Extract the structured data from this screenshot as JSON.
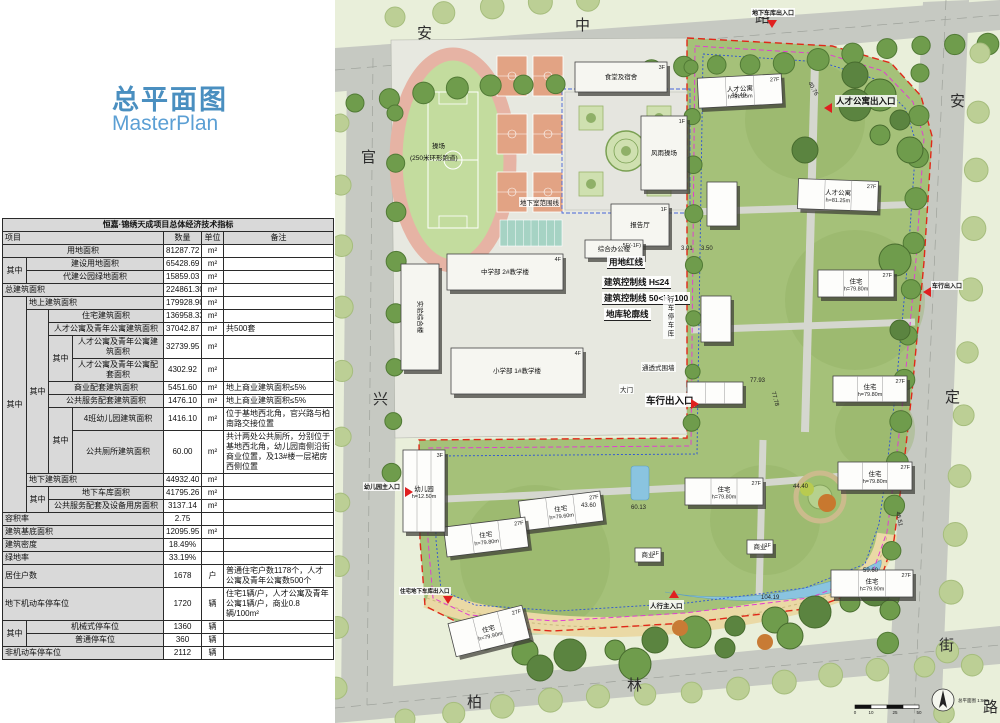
{
  "panel": {
    "title_cn": "总平面图",
    "title_en": "MasterPlan"
  },
  "table": {
    "rows": [
      [
        {
          "t": "恒嘉·锦绣天成项目总体经济技术指标",
          "cs": 7,
          "cls": "ttl"
        }
      ],
      [
        {
          "t": "项目",
          "cs": 4,
          "cls": "hd l"
        },
        {
          "t": "数量",
          "cls": "hd c"
        },
        {
          "t": "单位",
          "cls": "hd c"
        },
        {
          "t": "备注",
          "cls": "hd c"
        }
      ],
      [
        {
          "t": "用地面积",
          "cs": 4,
          "cls": "nm"
        },
        {
          "t": "81287.72",
          "cls": "num"
        },
        {
          "t": "m²",
          "cls": "unit"
        },
        {
          "t": "",
          "cls": "rmk"
        }
      ],
      [
        {
          "t": "其中",
          "rs": 2,
          "cls": "nm"
        },
        {
          "t": "建设用地面积",
          "cs": 3,
          "cls": "nm"
        },
        {
          "t": "65428.69",
          "cls": "num"
        },
        {
          "t": "m²",
          "cls": "unit"
        },
        {
          "t": "",
          "cls": "rmk"
        }
      ],
      [
        {
          "t": "代建公园绿地面积",
          "cs": 3,
          "cls": "nm"
        },
        {
          "t": "15859.03",
          "cls": "num"
        },
        {
          "t": "m²",
          "cls": "unit"
        },
        {
          "t": "",
          "cls": "rmk"
        }
      ],
      [
        {
          "t": "总建筑面积",
          "cs": 4,
          "cls": "nm l"
        },
        {
          "t": "224861.30",
          "cls": "num"
        },
        {
          "t": "m²",
          "cls": "unit"
        },
        {
          "t": "",
          "cls": "rmk"
        }
      ],
      [
        {
          "t": "其中",
          "rs": 12,
          "cls": "nm"
        },
        {
          "t": "地上建筑面积",
          "cs": 3,
          "cls": "nm l"
        },
        {
          "t": "179928.90",
          "cls": "num red"
        },
        {
          "t": "m²",
          "cls": "unit"
        },
        {
          "t": "",
          "cls": "rmk"
        }
      ],
      [
        {
          "t": "其中",
          "rs": 8,
          "cls": "nm"
        },
        {
          "t": "住宅建筑面积",
          "cs": 2,
          "cls": "nm"
        },
        {
          "t": "136958.33",
          "cls": "num"
        },
        {
          "t": "m²",
          "cls": "unit"
        },
        {
          "t": "",
          "cls": "rmk"
        }
      ],
      [
        {
          "t": "人才公寓及青年公寓建筑面积",
          "cs": 2,
          "cls": "nm"
        },
        {
          "t": "37042.87",
          "cls": "num"
        },
        {
          "t": "m²",
          "cls": "unit"
        },
        {
          "t": "共500套",
          "cls": "rmk"
        }
      ],
      [
        {
          "t": "其中",
          "rs": 2,
          "cls": "nm"
        },
        {
          "t": "人才公寓及青年公寓建筑面积",
          "cls": "nm"
        },
        {
          "t": "32739.95",
          "cls": "num"
        },
        {
          "t": "m²",
          "cls": "unit"
        },
        {
          "t": "",
          "cls": "rmk"
        }
      ],
      [
        {
          "t": "人才公寓及青年公寓配套面积",
          "cls": "nm"
        },
        {
          "t": "4302.92",
          "cls": "num"
        },
        {
          "t": "m²",
          "cls": "unit"
        },
        {
          "t": "",
          "cls": "rmk"
        }
      ],
      [
        {
          "t": "商业配套建筑面积",
          "cs": 2,
          "cls": "nm"
        },
        {
          "t": "5451.60",
          "cls": "num"
        },
        {
          "t": "m²",
          "cls": "unit"
        },
        {
          "t": "地上商业建筑面积≤5%",
          "cls": "rmk"
        }
      ],
      [
        {
          "t": "公共服务配套建筑面积",
          "cs": 2,
          "cls": "nm"
        },
        {
          "t": "1476.10",
          "cls": "num"
        },
        {
          "t": "m²",
          "cls": "unit"
        },
        {
          "t": "地上商业建筑面积≤5%",
          "cls": "rmk"
        }
      ],
      [
        {
          "t": "其中",
          "rs": 2,
          "cls": "nm"
        },
        {
          "t": "4班幼儿园建筑面积",
          "cls": "nm"
        },
        {
          "t": "1416.10",
          "cls": "num"
        },
        {
          "t": "m²",
          "cls": "unit"
        },
        {
          "t": "位于基地西北角，官兴路与柏南路交接位置",
          "cls": "rmk"
        }
      ],
      [
        {
          "t": "公共厕所建筑面积",
          "cls": "nm"
        },
        {
          "t": "60.00",
          "cls": "num"
        },
        {
          "t": "m²",
          "cls": "unit"
        },
        {
          "t": "共计两处公共厕所，分别位于基地西北角，幼儿园南侧沿街商业位置，及13#楼一层裙房西侧位置",
          "cls": "rmk"
        }
      ],
      [
        {
          "t": "地下建筑面积",
          "cs": 3,
          "cls": "nm l"
        },
        {
          "t": "44932.40",
          "cls": "num"
        },
        {
          "t": "m²",
          "cls": "unit"
        },
        {
          "t": "",
          "cls": "rmk"
        }
      ],
      [
        {
          "t": "其中",
          "rs": 2,
          "cls": "nm"
        },
        {
          "t": "地下车库面积",
          "cs": 2,
          "cls": "nm"
        },
        {
          "t": "41795.26",
          "cls": "num"
        },
        {
          "t": "m²",
          "cls": "unit"
        },
        {
          "t": "",
          "cls": "rmk"
        }
      ],
      [
        {
          "t": "公共服务配套及设备用房面积",
          "cs": 2,
          "cls": "nm"
        },
        {
          "t": "3137.14",
          "cls": "num"
        },
        {
          "t": "m²",
          "cls": "unit"
        },
        {
          "t": "",
          "cls": "rmk"
        }
      ],
      [
        {
          "t": "容积率",
          "cs": 4,
          "cls": "nm l"
        },
        {
          "t": "2.75",
          "cls": "num red"
        },
        {
          "t": "",
          "cls": "unit"
        },
        {
          "t": "",
          "cls": "rmk"
        }
      ],
      [
        {
          "t": "建筑基底面积",
          "cs": 4,
          "cls": "nm l"
        },
        {
          "t": "12095.95",
          "cls": "num"
        },
        {
          "t": "m²",
          "cls": "unit"
        },
        {
          "t": "",
          "cls": "rmk"
        }
      ],
      [
        {
          "t": "建筑密度",
          "cs": 4,
          "cls": "nm l"
        },
        {
          "t": "18.49%",
          "cls": "num"
        },
        {
          "t": "",
          "cls": "unit"
        },
        {
          "t": "",
          "cls": "rmk"
        }
      ],
      [
        {
          "t": "绿地率",
          "cs": 4,
          "cls": "nm l"
        },
        {
          "t": "33.19%",
          "cls": "num"
        },
        {
          "t": "",
          "cls": "unit"
        },
        {
          "t": "",
          "cls": "rmk"
        }
      ],
      [
        {
          "t": "居住户数",
          "cs": 4,
          "cls": "nm l"
        },
        {
          "t": "1678",
          "cls": "num"
        },
        {
          "t": "户",
          "cls": "unit"
        },
        {
          "t": "普通住宅户数1178个，人才公寓及青年公寓数500个",
          "cls": "rmk"
        }
      ],
      [
        {
          "t": "地下机动车停车位",
          "cs": 4,
          "cls": "nm l"
        },
        {
          "t": "1720",
          "cls": "num"
        },
        {
          "t": "辆",
          "cls": "unit"
        },
        {
          "t": "住宅1辆/户，人才公寓及青年公寓1辆/户，商业0.8辆/100m²",
          "cls": "rmk"
        }
      ],
      [
        {
          "t": "其中",
          "rs": 2,
          "cls": "nm"
        },
        {
          "t": "机械式停车位",
          "cs": 3,
          "cls": "nm"
        },
        {
          "t": "1360",
          "cls": "num"
        },
        {
          "t": "辆",
          "cls": "unit"
        },
        {
          "t": "",
          "cls": "rmk"
        }
      ],
      [
        {
          "t": "普通停车位",
          "cs": 3,
          "cls": "nm"
        },
        {
          "t": "360",
          "cls": "num"
        },
        {
          "t": "辆",
          "cls": "unit"
        },
        {
          "t": "",
          "cls": "rmk"
        }
      ],
      [
        {
          "t": "非机动车停车位",
          "cs": 4,
          "cls": "nm l"
        },
        {
          "t": "2112",
          "cls": "num"
        },
        {
          "t": "辆",
          "cls": "unit"
        },
        {
          "t": "",
          "cls": "rmk"
        }
      ]
    ]
  },
  "map": {
    "streets": [
      {
        "t": "安",
        "x": 82,
        "y": 22
      },
      {
        "t": "中",
        "x": 240,
        "y": 14
      },
      {
        "t": "路",
        "x": 420,
        "y": 6
      },
      {
        "t": "安",
        "x": 615,
        "y": 90
      },
      {
        "t": "定",
        "x": 610,
        "y": 386
      },
      {
        "t": "街",
        "x": 604,
        "y": 634
      },
      {
        "t": "官",
        "x": 26,
        "y": 146
      },
      {
        "t": "兴",
        "x": 38,
        "y": 388
      },
      {
        "t": "柏",
        "x": 132,
        "y": 691
      },
      {
        "t": "林",
        "x": 292,
        "y": 674
      },
      {
        "t": "路",
        "x": 648,
        "y": 696
      }
    ],
    "legend": [
      {
        "t": "用地红线",
        "x": 272,
        "y": 256
      },
      {
        "t": "建筑控制线 H≤24",
        "x": 267,
        "y": 276
      },
      {
        "t": "建筑控制线 50<H≤100",
        "x": 267,
        "y": 292
      },
      {
        "t": "地库轮廓线",
        "x": 269,
        "y": 308
      }
    ],
    "entrances": [
      {
        "t": "地下车库出入口",
        "x": 416,
        "y": 8,
        "fs": 6,
        "tri": "down",
        "tx": 432,
        "ty": 20
      },
      {
        "t": "人才公寓出入口",
        "x": 500,
        "y": 95,
        "fs": 8.5,
        "tri": "left",
        "tx": 489,
        "ty": 103
      },
      {
        "t": "车行出入口",
        "x": 310,
        "y": 393,
        "fs": 9.5,
        "tri": "right",
        "tx": 356,
        "ty": 399
      },
      {
        "t": "车行出入口",
        "x": 596,
        "y": 281,
        "fs": 6,
        "tri": "left",
        "tx": 588,
        "ty": 287
      },
      {
        "t": "幼儿园主入口",
        "x": 28,
        "y": 482,
        "fs": 6,
        "tri": "right",
        "tx": 70,
        "ty": 487
      },
      {
        "t": "住宅地下车库出入口",
        "x": 64,
        "y": 587,
        "fs": 5.5,
        "tri": "down",
        "tx": 108,
        "ty": 596
      },
      {
        "t": "人行主入口",
        "x": 314,
        "y": 600,
        "fs": 6.5,
        "tri": "up",
        "tx": 334,
        "ty": 590
      }
    ],
    "misc": [
      {
        "t": "通透式围墙",
        "x": 306,
        "y": 362
      },
      {
        "t": "大门",
        "x": 284,
        "y": 384
      },
      {
        "t": "操场",
        "x": 96,
        "y": 140,
        "nobg": true
      },
      {
        "t": "(250米环形跑道)",
        "x": 74,
        "y": 152,
        "nobg": true
      },
      {
        "t": "地下室范围线",
        "x": 184,
        "y": 197
      },
      {
        "t": "行车停车库",
        "x": 328,
        "y": 296,
        "v": true
      }
    ],
    "dims": [
      {
        "t": "46.40",
        "x": 396,
        "y": 93
      },
      {
        "t": "40.76",
        "x": 470,
        "y": 86,
        "rot": 62
      },
      {
        "t": "44.40",
        "x": 458,
        "y": 484
      },
      {
        "t": "77.93",
        "x": 415,
        "y": 378
      },
      {
        "t": "77.78",
        "x": 432,
        "y": 396,
        "rot": 75
      },
      {
        "t": "43.60",
        "x": 246,
        "y": 503
      },
      {
        "t": "60.13",
        "x": 296,
        "y": 505
      },
      {
        "t": "59.60",
        "x": 528,
        "y": 568
      },
      {
        "t": "104.19",
        "x": 426,
        "y": 595
      },
      {
        "t": "46.51",
        "x": 556,
        "y": 516,
        "rot": 78
      },
      {
        "t": "3.01",
        "x": 346,
        "y": 246
      },
      {
        "t": "3.50",
        "x": 366,
        "y": 246
      }
    ],
    "buildings": [
      {
        "x": 363,
        "y": 76,
        "w": 84,
        "h": 30,
        "rot": -3,
        "n": "人才公寓",
        "f": "27F",
        "e": "h=81.25m"
      },
      {
        "x": 463,
        "y": 180,
        "w": 80,
        "h": 30,
        "rot": 2,
        "n": "人才公寓",
        "f": "27F",
        "e": "h=81.25m"
      },
      {
        "x": 372,
        "y": 182,
        "w": 30,
        "h": 44
      },
      {
        "x": 483,
        "y": 270,
        "w": 76,
        "h": 27,
        "n": "住宅",
        "f": "27F",
        "e": "h=79.80m"
      },
      {
        "x": 366,
        "y": 296,
        "w": 30,
        "h": 46
      },
      {
        "x": 498,
        "y": 376,
        "w": 74,
        "h": 26,
        "n": "住宅",
        "f": "27F",
        "e": "h=79.80m"
      },
      {
        "x": 352,
        "y": 382,
        "w": 56,
        "h": 22
      },
      {
        "x": 350,
        "y": 478,
        "w": 78,
        "h": 27,
        "n": "住宅",
        "f": "27F",
        "e": "h=79.80m"
      },
      {
        "x": 503,
        "y": 462,
        "w": 74,
        "h": 28,
        "n": "住宅",
        "f": "27F",
        "e": "h=79.80m"
      },
      {
        "x": 496,
        "y": 570,
        "w": 82,
        "h": 27,
        "n": "住宅",
        "f": "27F",
        "e": "h=79.90m"
      },
      {
        "x": 185,
        "y": 496,
        "w": 82,
        "h": 30,
        "rot": -7,
        "n": "住宅",
        "f": "27F",
        "e": "h=79.60m"
      },
      {
        "x": 110,
        "y": 522,
        "w": 82,
        "h": 30,
        "rot": -7,
        "n": "住宅",
        "f": "27F",
        "e": "h=79.80m"
      },
      {
        "x": 116,
        "y": 614,
        "w": 76,
        "h": 34,
        "rot": -14,
        "n": "住宅",
        "f": "27F",
        "e": "h=79.90m"
      },
      {
        "x": 68,
        "y": 450,
        "w": 42,
        "h": 82,
        "n": "幼儿园",
        "f": "3F",
        "e": "h=12.50m"
      },
      {
        "x": 300,
        "y": 548,
        "w": 26,
        "h": 14,
        "n": "商业",
        "f": "1F"
      },
      {
        "x": 412,
        "y": 540,
        "w": 26,
        "h": 14,
        "n": "商业",
        "f": "1F"
      }
    ],
    "school": [
      {
        "x": 240,
        "y": 62,
        "w": 92,
        "h": 30,
        "n": "食堂及宿舍",
        "f": "3F"
      },
      {
        "x": 306,
        "y": 116,
        "w": 46,
        "h": 74,
        "n": "风雨操场",
        "f": "1F"
      },
      {
        "x": 276,
        "y": 204,
        "w": 58,
        "h": 42,
        "n": "报告厅",
        "f": "1F"
      },
      {
        "x": 250,
        "y": 240,
        "w": 58,
        "h": 18,
        "n": "综合办公楼",
        "f": "5F(-1F)"
      },
      {
        "x": 112,
        "y": 254,
        "w": 116,
        "h": 36,
        "n": "中学部 2#教学楼",
        "f": "4F"
      },
      {
        "x": 66,
        "y": 264,
        "w": 38,
        "h": 106,
        "n": "实验综合楼",
        "v": true
      },
      {
        "x": 116,
        "y": 348,
        "w": 132,
        "h": 46,
        "n": "小学部 1#教学楼",
        "f": "4F"
      }
    ],
    "compass": {
      "label": "总平面图 1:500",
      "ticks": [
        "0",
        "10",
        "25",
        "50"
      ]
    }
  }
}
